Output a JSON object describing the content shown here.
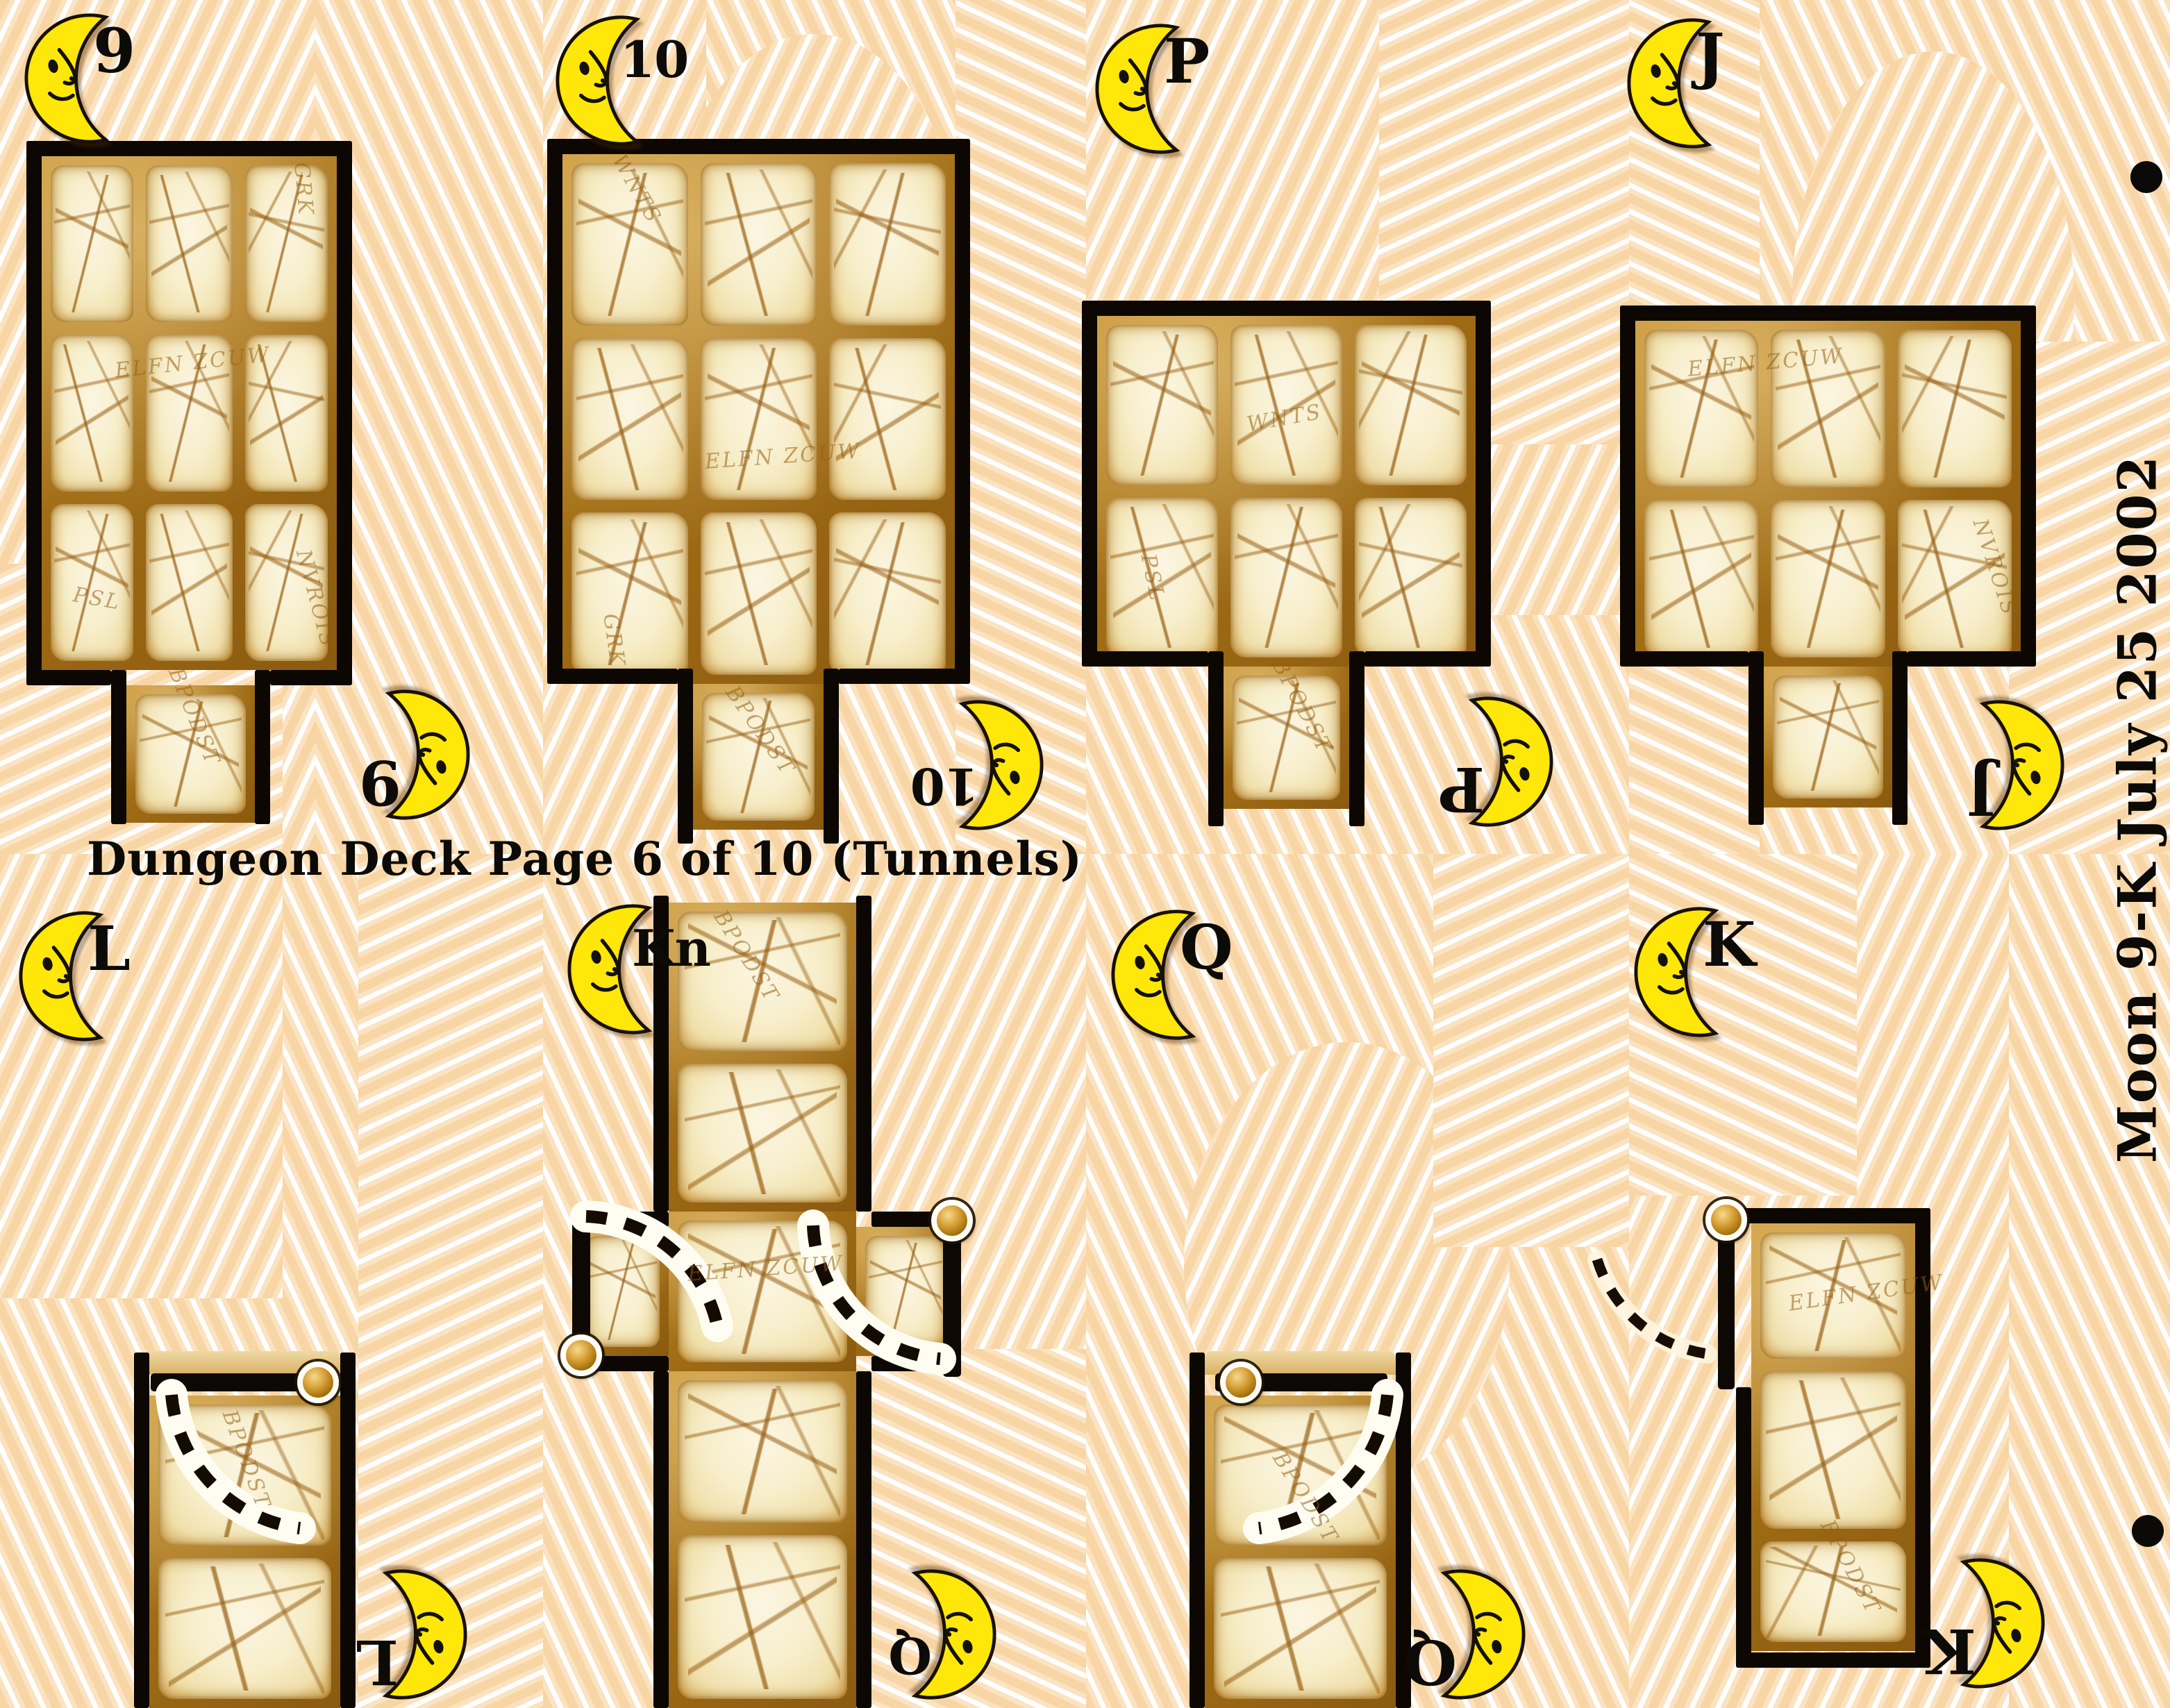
{
  "page": {
    "title": "Dungeon Deck Page 6 of 10 (Tunnels)",
    "side_label": "Moon 9-K July 25 2002",
    "deck_name": "Dungeon Deck",
    "page_number": "6",
    "page_count": "10",
    "theme": "Tunnels",
    "suit": "Moon",
    "colors": {
      "background_peach": "#f8d5a4",
      "stripe_white": "#ffffff",
      "mortar_brown": "#a06c14",
      "stone_cream": "#f7eecb",
      "wall_black": "#0c0703",
      "moon_yellow": "#ffe70a",
      "text_black": "#0c0a06",
      "hinge_gold": "#c8860a"
    }
  },
  "cards": [
    {
      "rank": "9",
      "map": "3x3 stone room, tunnel exit at bottom"
    },
    {
      "rank": "10",
      "map": "3x3 stone room, tunnel exit at bottom"
    },
    {
      "rank": "P",
      "map": "3x2 stone room, tunnel exit at bottom"
    },
    {
      "rank": "J",
      "map": "3x2 stone room, tunnel exit at bottom"
    },
    {
      "rank": "L",
      "map": "corridor with hinged door at top"
    },
    {
      "rank": "Kn",
      "map": "cross tunnel with two hinged doors"
    },
    {
      "rank": "Q",
      "map": "corridor with hinged door at top"
    },
    {
      "rank": "K",
      "map": "dead-end room with outward door on left"
    }
  ],
  "runes": [
    "ELFN ZCUW",
    "GRK",
    "WNTS",
    "NVROIS",
    "BPODST",
    "PSL"
  ]
}
